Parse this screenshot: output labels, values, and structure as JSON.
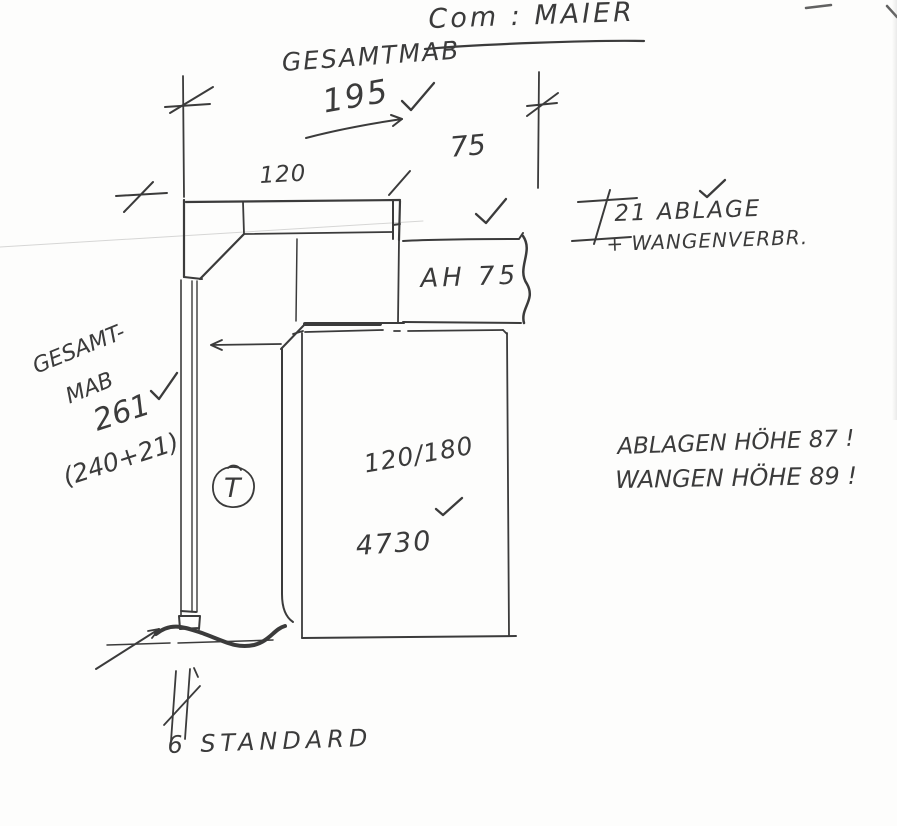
{
  "title": "Com : MAIER",
  "annotations": {
    "overall_width_label": "GESAMTMAB",
    "overall_width_value": "195",
    "width_left": "120",
    "width_right": "75",
    "shelf_note_line1": "21 ABLAGE",
    "shelf_note_line2": "+ WANGENVERBR.",
    "shelf_label": "AH 75",
    "overall_height_label_line1": "GESAMT-",
    "overall_height_label_line2": "MAB",
    "overall_height_value": "261",
    "overall_height_formula": "(240+21)",
    "circle_mark": "T",
    "desk_size": "120/180",
    "desk_model": "4730",
    "height_note_line1": "ABLAGEN HÖHE 87 !",
    "height_note_line2": "WANGEN HÖHE 89 !",
    "base_note": "6 STANDARD"
  },
  "colors": {
    "ink": "#3b3b3b",
    "paper": "#fdfdfc"
  }
}
